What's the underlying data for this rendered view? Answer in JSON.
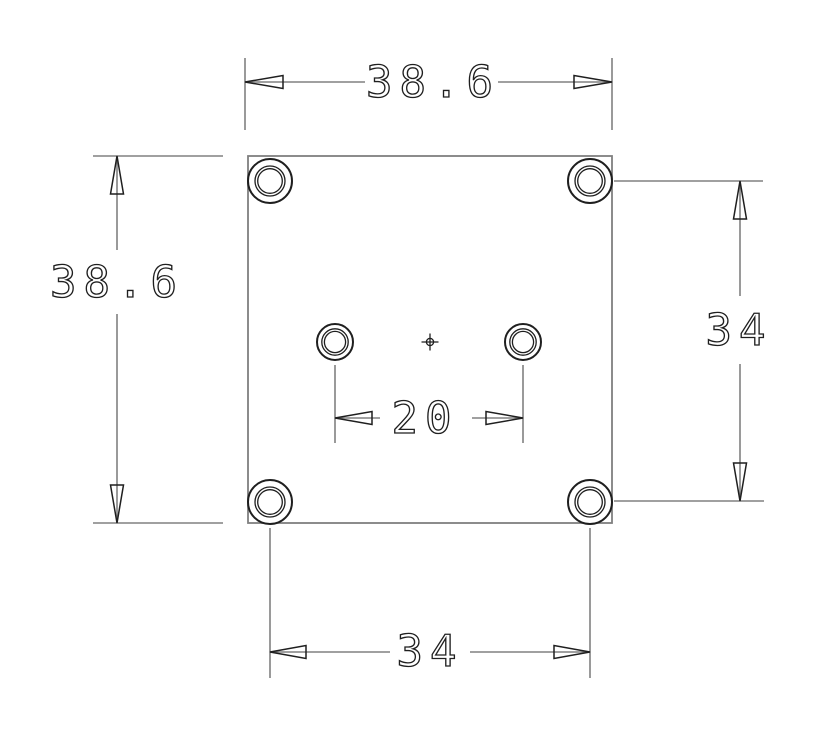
{
  "drawing": {
    "description": "Dimensioned top view of a square plate with four corner counterbored holes, two center holes and a center mark",
    "dimensions": {
      "top_width": "38.6",
      "left_height": "38.6",
      "right_vertical_hole_spacing": "34",
      "bottom_horizontal_hole_spacing": "34",
      "center_hole_spacing": "20"
    },
    "colors": {
      "geometry_line": "#808080",
      "detail_line": "#1f1f1f",
      "background": "#ffffff"
    }
  }
}
